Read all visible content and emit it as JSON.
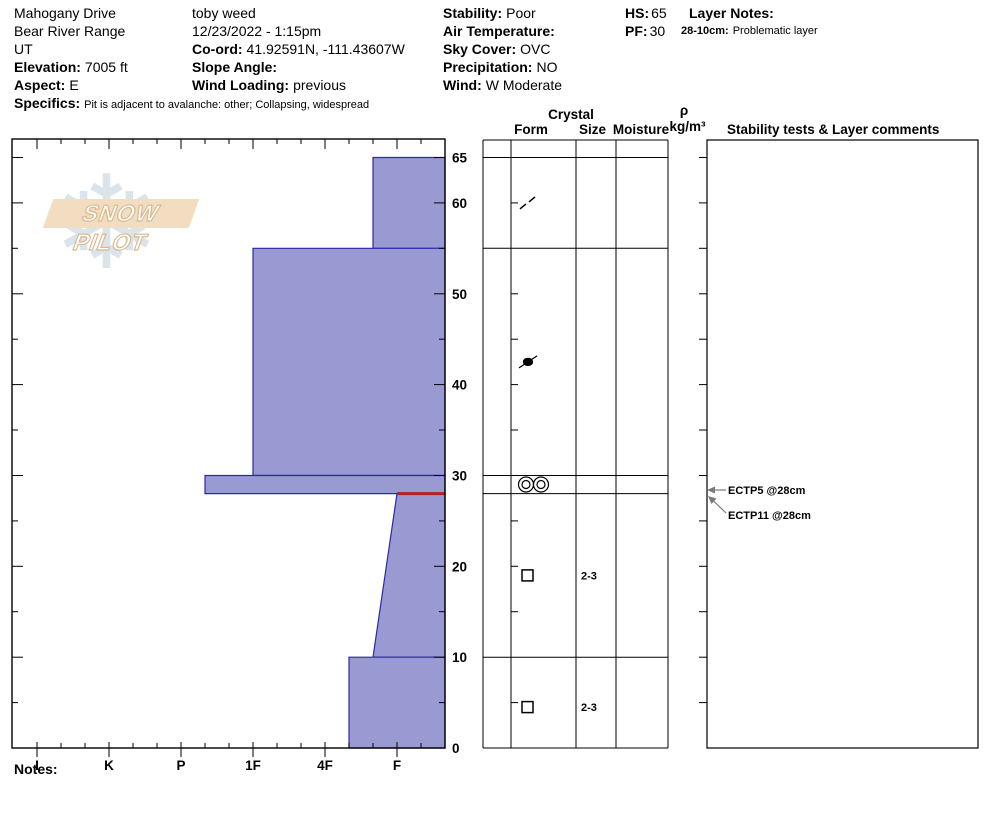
{
  "header": {
    "site": {
      "line1": "Mahogany Drive",
      "line2": "Bear River Range",
      "line3": "UT",
      "elevation_label": "Elevation:",
      "elevation_value": "7005 ft",
      "aspect_label": "Aspect:",
      "aspect_value": "E",
      "specifics_label": "Specifics:",
      "specifics_value": "Pit is adjacent to avalanche: other;  Collapsing, widespread"
    },
    "observer": {
      "name": "toby weed",
      "datetime": "12/23/2022 - 1:15pm",
      "coord_label": "Co-ord:",
      "coord_value": "41.92591N, -111.43607W",
      "slope_label": "Slope Angle:",
      "slope_value": "",
      "windload_label": "Wind Loading:",
      "windload_value": "previous"
    },
    "conditions": {
      "stability_label": "Stability:",
      "stability_value": "Poor",
      "airtemp_label": "Air Temperature:",
      "airtemp_value": "",
      "sky_label": "Sky Cover:",
      "sky_value": "OVC",
      "precip_label": "Precipitation:",
      "precip_value": "NO",
      "wind_label": "Wind:",
      "wind_value": "W Moderate"
    },
    "totals": {
      "hs_label": "HS:",
      "hs_value": "65",
      "pf_label": "PF:",
      "pf_value": "30"
    },
    "layer_notes": {
      "label": "Layer Notes:",
      "note_range": "28-10cm:",
      "note_text": "Problematic layer"
    }
  },
  "columns": {
    "crystal": "Crystal",
    "form": "Form",
    "size": "Size",
    "moisture": "Moisture",
    "rho": "ρ",
    "rho_units": "kg/m³",
    "stability": "Stability tests & Layer comments"
  },
  "notes_label": "Notes:",
  "logo": {
    "text": "SNOW PILOT",
    "banner_color": "#f3ddc1",
    "text_color": "#ffffff",
    "outline_color": "#d9b88f",
    "flake_color": "#cdd9e2",
    "flake_glyph": "❄"
  },
  "chart_data": {
    "type": "bar",
    "subtype": "snow-hardness-profile",
    "title": "Snowpit hardness profile",
    "xlabel": "Hand hardness",
    "ylabel": "Depth (cm)",
    "hardness_labels": [
      "I",
      "K",
      "P",
      "1F",
      "4F",
      "F"
    ],
    "depth_labels": [
      0,
      10,
      20,
      30,
      40,
      50,
      60,
      65
    ],
    "depth_max_cm": 65,
    "layers": [
      {
        "top": 65,
        "bottom": 55,
        "hardness": "F+"
      },
      {
        "top": 55,
        "bottom": 30,
        "hardness": "1F"
      },
      {
        "top": 30,
        "bottom": 28,
        "hardness": "P-"
      },
      {
        "top": 28,
        "bottom": 10,
        "hardness_top": "F",
        "hardness_bottom": "F+",
        "flagged": true
      },
      {
        "top": 10,
        "bottom": 0,
        "hardness": "4F-"
      }
    ],
    "table_boundaries": [
      65,
      55,
      30,
      28,
      10
    ],
    "grains": [
      {
        "depth": 60,
        "symbol": "slash-fragments",
        "size": ""
      },
      {
        "depth": 42.5,
        "symbol": "dot",
        "size": ""
      },
      {
        "depth": 29,
        "symbol": "double-circles",
        "size": ""
      },
      {
        "depth": 19,
        "symbol": "square",
        "size": "2-3"
      },
      {
        "depth": 4.5,
        "symbol": "square",
        "size": "2-3"
      }
    ],
    "tests": [
      {
        "label": "ECTP5 @28cm",
        "depth": 28
      },
      {
        "label": "ECTP11 @28cm",
        "depth": 28
      }
    ],
    "style": {
      "layer_fill": "#9a9ad2",
      "layer_stroke": "#2929ab",
      "flag_color": "#b22222",
      "arrow_color": "#7a7a7a",
      "line_color": "#000000"
    }
  }
}
